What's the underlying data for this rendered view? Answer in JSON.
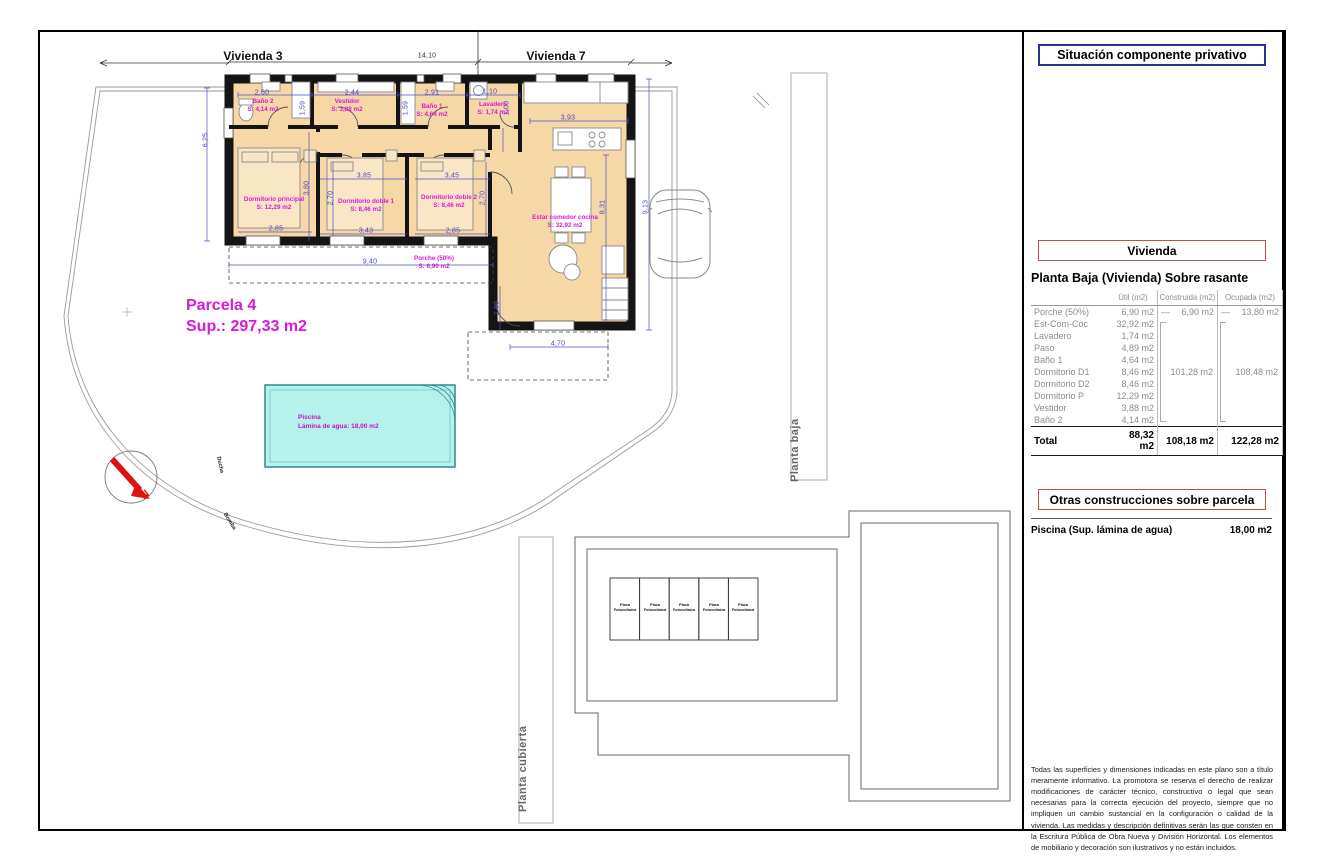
{
  "plan": {
    "vivienda3": "Vivienda 3",
    "vivienda7": "Vivienda 7",
    "parcela": {
      "title": "Parcela 4",
      "sup": "Sup.: 297,33 m2"
    },
    "pool": {
      "title": "Piscina",
      "subtitle": "Lámina de agua: 18,00 m2"
    },
    "annotations": {
      "ducha": "Ducha",
      "bomba": "Bomba",
      "north": "N",
      "planta_baja": "Planta baja",
      "planta_cubierta": "Planta cubierta"
    },
    "rooms": [
      {
        "name": "Baño 2",
        "area": "S: 4,14 m2",
        "x": 263,
        "y": 106
      },
      {
        "name": "Vestidor",
        "area": "S: 3,88 m2",
        "x": 347,
        "y": 106
      },
      {
        "name": "Baño 1",
        "area": "S: 4,64 m2",
        "x": 432,
        "y": 111
      },
      {
        "name": "Lavadero",
        "area": "S: 1,74 m2",
        "x": 493,
        "y": 109
      },
      {
        "name": "Dormitorio principal",
        "area": "S: 12,29 m2",
        "x": 274,
        "y": 204
      },
      {
        "name": "Dormitorio doble 1",
        "area": "S: 8,46 m2",
        "x": 366,
        "y": 206
      },
      {
        "name": "Dormitorio doble 2",
        "area": "S: 8,46 m2",
        "x": 449,
        "y": 202
      },
      {
        "name": "Estar comedor cocina",
        "area": "S: 32,92 m2",
        "x": 565,
        "y": 222
      },
      {
        "name": "Porche (50%)",
        "area": "S: 6,90 m2",
        "x": 434,
        "y": 263
      }
    ],
    "dimensions": [
      {
        "t": "14,10",
        "x": 427,
        "y": 56,
        "v": false,
        "c": "#333333"
      },
      {
        "t": "2,60",
        "x": 262,
        "y": 93,
        "v": false
      },
      {
        "t": "2,44",
        "x": 352,
        "y": 93,
        "v": false
      },
      {
        "t": "2,91",
        "x": 432,
        "y": 93,
        "v": false
      },
      {
        "t": "1,10",
        "x": 490,
        "y": 92,
        "v": false
      },
      {
        "t": "3,93",
        "x": 568,
        "y": 118,
        "v": false
      },
      {
        "t": "1,59",
        "x": 303,
        "y": 108,
        "v": true
      },
      {
        "t": "1,59",
        "x": 406,
        "y": 108,
        "v": true
      },
      {
        "t": "1,00",
        "x": 507,
        "y": 108,
        "v": true
      },
      {
        "t": "6,25",
        "x": 206,
        "y": 140,
        "v": true
      },
      {
        "t": "3,85",
        "x": 364,
        "y": 176,
        "v": false
      },
      {
        "t": "3,45",
        "x": 452,
        "y": 176,
        "v": false
      },
      {
        "t": "3,80",
        "x": 307,
        "y": 188,
        "v": true
      },
      {
        "t": "2,70",
        "x": 331,
        "y": 198,
        "v": true
      },
      {
        "t": "2,70",
        "x": 483,
        "y": 198,
        "v": true
      },
      {
        "t": "2,85",
        "x": 276,
        "y": 229,
        "v": false
      },
      {
        "t": "3,43",
        "x": 366,
        "y": 231,
        "v": false
      },
      {
        "t": "2,85",
        "x": 453,
        "y": 231,
        "v": false
      },
      {
        "t": "9,40",
        "x": 370,
        "y": 262,
        "v": false
      },
      {
        "t": "2,80",
        "x": 497,
        "y": 308,
        "v": true
      },
      {
        "t": "4,70",
        "x": 558,
        "y": 344,
        "v": false
      },
      {
        "t": "8,31",
        "x": 603,
        "y": 207,
        "v": true
      },
      {
        "t": "9,13",
        "x": 646,
        "y": 207,
        "v": true
      }
    ],
    "roof": {
      "panel_line1": "Placa",
      "panel_line2": "Fotovoltaica",
      "panel_centers": [
        [
          625,
          608
        ],
        [
          655,
          608
        ],
        [
          684,
          608
        ],
        [
          714,
          608
        ],
        [
          743,
          608
        ]
      ]
    }
  },
  "panel": {
    "situacion_title": "Situación componente privativo",
    "site_plan": {
      "units": [
        {
          "id": "P-8",
          "tipo": "Tipo A",
          "x": 1062,
          "y": 134
        },
        {
          "id": "P-1",
          "tipo": "Tipo A",
          "x": 1062,
          "y": 168
        },
        {
          "id": "P-6",
          "tipo": "Tipo A",
          "x": 1112,
          "y": 129
        },
        {
          "id": "P-2",
          "tipo": "Tipo A",
          "x": 1112,
          "y": 162
        },
        {
          "id": "P-7",
          "tipo": "Tipo A",
          "x": 1160,
          "y": 121
        },
        {
          "id": "P-3",
          "tipo": "Tipo A",
          "x": 1160,
          "y": 154
        },
        {
          "id": "P-4",
          "tipo": "Tipo A",
          "x": 1223,
          "y": 127
        }
      ]
    },
    "vivienda_title": "Vivienda",
    "table": {
      "heading": "Planta Baja (Vivienda) Sobre rasante",
      "columns": [
        "",
        "Útil (m2)",
        "Construida (m2)",
        "Ocupada (m2)"
      ],
      "dash": "—",
      "rows": [
        {
          "name": "Porche (50%)",
          "util": "6,90 m2",
          "construida": "6,90 m2",
          "ocupada": "13,80 m2",
          "dash": true
        },
        {
          "name": "Est-Com-Coc",
          "util": "32,92 m2"
        },
        {
          "name": "Lavadero",
          "util": "1,74 m2"
        },
        {
          "name": "Paso",
          "util": "4,89 m2"
        },
        {
          "name": "Baño 1",
          "util": "4,64 m2"
        },
        {
          "name": "Dormitorio D1",
          "util": "8,46 m2"
        },
        {
          "name": "Dormitorio D2",
          "util": "8,46 m2"
        },
        {
          "name": "Dormitorio P",
          "util": "12,29 m2"
        },
        {
          "name": "Vestidor",
          "util": "3,88 m2"
        },
        {
          "name": "Baño 2",
          "util": "4,14 m2"
        }
      ],
      "construida_group": "101,28 m2",
      "ocupada_group": "108,48 m2",
      "total": {
        "name": "Total",
        "util": "88,32 m2",
        "construida": "108,18 m2",
        "ocupada": "122,28 m2"
      }
    },
    "otras_title": "Otras construcciones sobre parcela",
    "piscina_row": {
      "label": "Piscina (Sup. lámina de agua)",
      "value": "18,00 m2"
    },
    "disclaimer": "Todas las superficies y dimensiones indicadas en este plano son a título meramente informativo. La promotora se reserva el derecho de realizar modificaciones de carácter técnico, constructivo o legal que sean necesarias para la correcta ejecución del proyecto, siempre que no impliquen un cambio sustancial en la configuración o calidad de la vivienda. Las medidas y descripción definitivas serán las que consten en la Escritura Pública de Obra Nueva y División Horizontal. Los elementos de mobiliario y decoración son ilustrativos y no están incluidos."
  },
  "colors": {
    "magenta": "#d819d8",
    "dim_blue": "#4646c8",
    "red_box": "#c0504d",
    "navy_box": "#2e3192",
    "pool_fill": "#b6f2ec",
    "gray_text": "#8c8c8c",
    "north_red": "#dd1111",
    "floor_fill": "#f6d7a6",
    "highlight": "#dcc0ea"
  }
}
